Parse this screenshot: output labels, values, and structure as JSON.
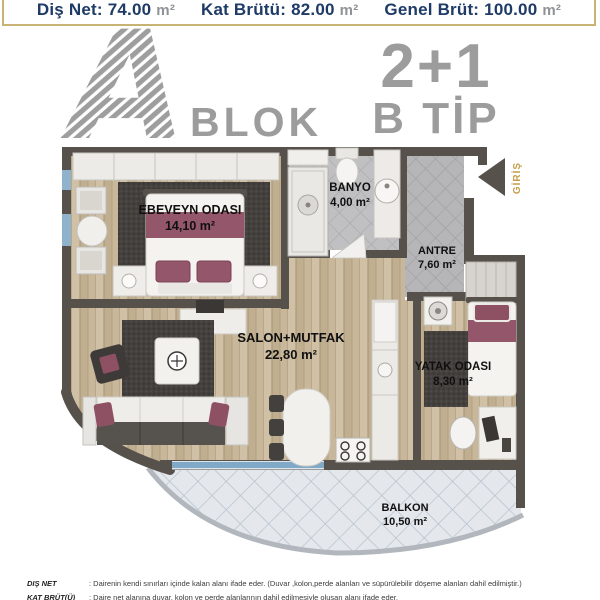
{
  "header_bar": {
    "items": [
      {
        "label": "Diş Net:",
        "value": "74.00",
        "unit": "m²"
      },
      {
        "label": "Kat Brütü:",
        "value": "82.00",
        "unit": "m²"
      },
      {
        "label": "Genel Brüt:",
        "value": "100.00",
        "unit": "m²"
      }
    ]
  },
  "branding": {
    "block_letter": "A",
    "block_word": "BLOK",
    "unit_layout": "2+1",
    "unit_type": "B TİP"
  },
  "plan": {
    "entrance_label": "GİRİŞ",
    "rooms": [
      {
        "id": "ebeveyn",
        "name": "EBEVEYN ODASI",
        "area": "14,10 m²"
      },
      {
        "id": "banyo",
        "name": "BANYO",
        "area": "4,00 m²"
      },
      {
        "id": "antre",
        "name": "ANTRE",
        "area": "7,60 m²"
      },
      {
        "id": "salon",
        "name": "SALON+MUTFAK",
        "area": "22,80 m²"
      },
      {
        "id": "yatak",
        "name": "YATAK ODASI",
        "area": "8,30 m²"
      },
      {
        "id": "balkon",
        "name": "BALKON",
        "area": "10,50 m²"
      }
    ]
  },
  "footnotes": [
    {
      "term": "DIŞ NET",
      "definition": ": Dairenin kendi sınırları içinde kalan alanı ifade eder. (Duvar ,kolon,perde alanları ve süpürülebilir döşeme alanları dahil edilmiştir.)"
    },
    {
      "term": "KAT BRÜT(Ü)",
      "definition": ": Daire net alanına duvar, kolon ve perde alanlarının dahil edilmesiyle oluşan alanı ifade eder."
    }
  ],
  "colors": {
    "accent_gold": "#c8b274",
    "navy_text": "#1e3a66",
    "brand_gray": "#9c9c9c",
    "wall": "#57514c",
    "entrance_gold": "#c59f4b",
    "maroon_accent": "#94566a"
  }
}
